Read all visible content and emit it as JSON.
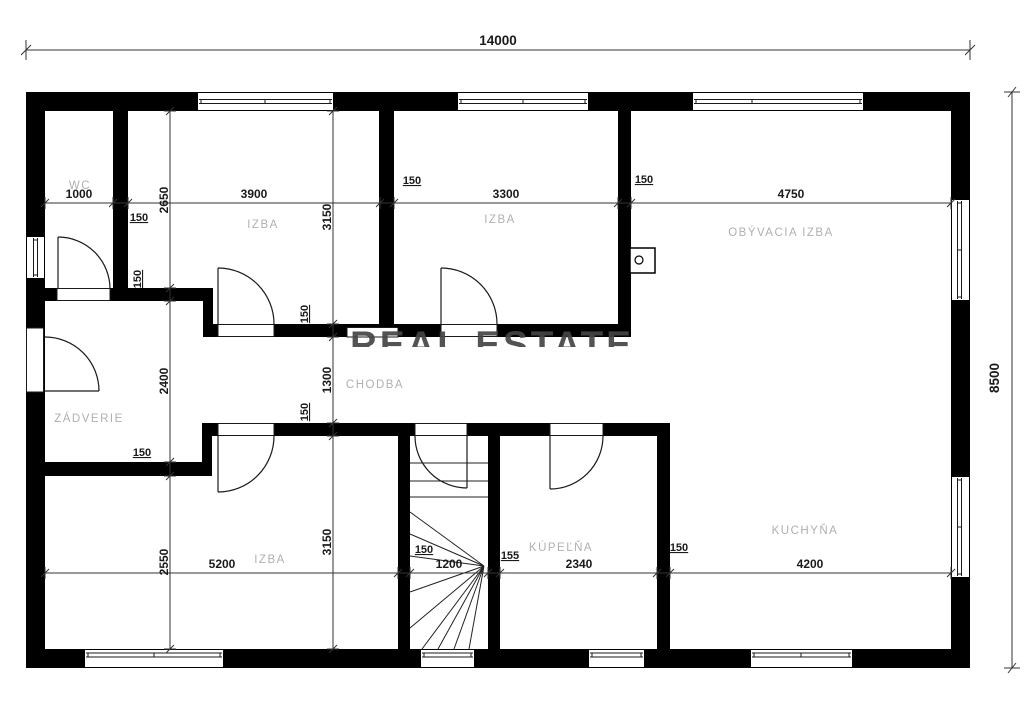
{
  "overall": {
    "width": "14000",
    "height": "8500"
  },
  "top_chain": {
    "wc": "1000",
    "izba1": "3900",
    "izba2": "3300",
    "living": "4750"
  },
  "bottom_chain": {
    "izba3": "5200",
    "stairs": "1200",
    "kupelna": "2340",
    "kuchyna": "4200"
  },
  "left_chain": {
    "top": "2650",
    "middle": "2400",
    "bottom": "2550"
  },
  "center_chain": {
    "top": "3150",
    "middle": "1300",
    "bottom": "3150"
  },
  "wall_thickness": {
    "v1": "150",
    "v2": "150",
    "v3": "150",
    "h1": "150",
    "h2": "150",
    "h3": "150",
    "h4": "150",
    "stairs_left": "150",
    "stairs_right": "155",
    "kitchen": "150"
  },
  "rooms": {
    "wc": "WC",
    "izba1": "IZBA",
    "izba2": "IZBA",
    "living": "OBÝVACIA IZBA",
    "zadverie": "ZÁDVERIE",
    "chodba": "CHODBA",
    "izba3": "IZBA",
    "kupelna": "KÚPEĽŇA",
    "kuchyna": "KUCHYŇA"
  },
  "watermark": {
    "text": "REAL ESTATE"
  },
  "colors": {
    "wall": "#000000",
    "background": "#ffffff",
    "room_label": "#b0b0b0",
    "dimension": "#1a1a1a",
    "watermark": "#454545"
  }
}
